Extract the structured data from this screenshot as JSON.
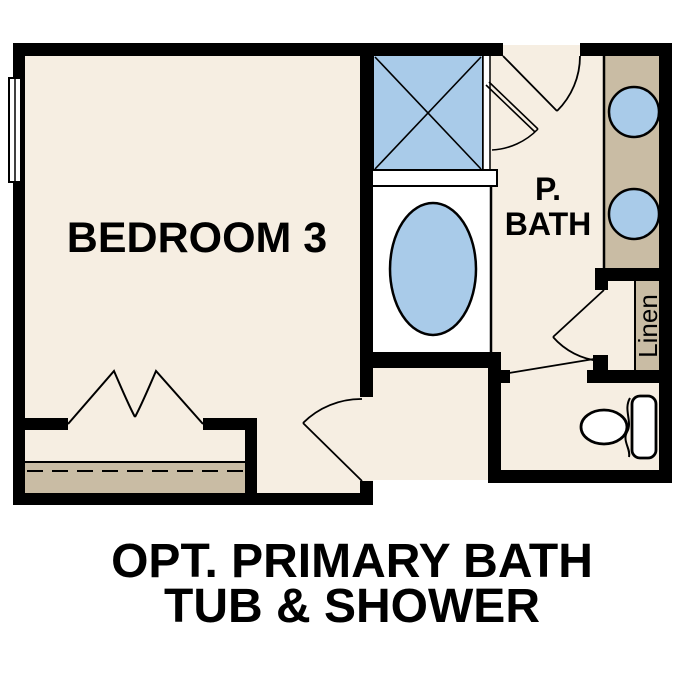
{
  "plan": {
    "labels": {
      "bedroom": "BEDROOM 3",
      "bath_line1": "P.",
      "bath_line2": "BATH",
      "linen": "Linen"
    },
    "caption": {
      "line1": "OPT. PRIMARY BATH",
      "line2": "TUB & SHOWER"
    },
    "colors": {
      "background": "#FFFFFF",
      "floor": "#F6EEE2",
      "fixture_blue": "#A9CBE9",
      "counter_tan": "#C9BCA4",
      "wall": "#000000",
      "line": "#000000"
    }
  }
}
